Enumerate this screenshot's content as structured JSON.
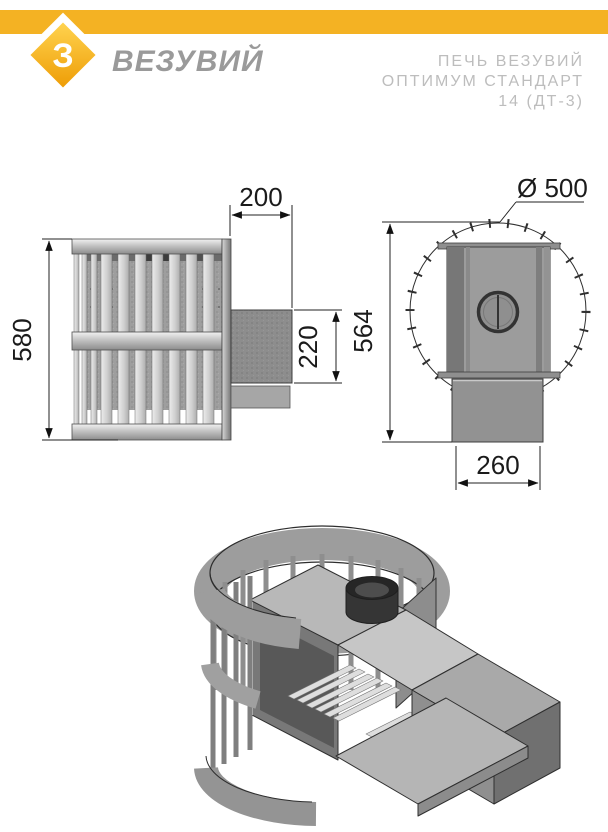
{
  "header": {
    "accent_color": "#F4B223",
    "logo_glyph": "З",
    "brand": "ВЕЗУВИЙ",
    "title_line1": "ПЕЧЬ ВЕЗУВИЙ",
    "title_line2": "ОПТИМУМ СТАНДАРТ",
    "title_line3": "14 (ДТ-3)"
  },
  "drawing": {
    "front_view": {
      "overall_height": "580",
      "duct_length": "200",
      "duct_height": "220"
    },
    "side_view": {
      "cage_diameter": "Ø 500",
      "overall_height": "564",
      "base_width": "260"
    }
  }
}
